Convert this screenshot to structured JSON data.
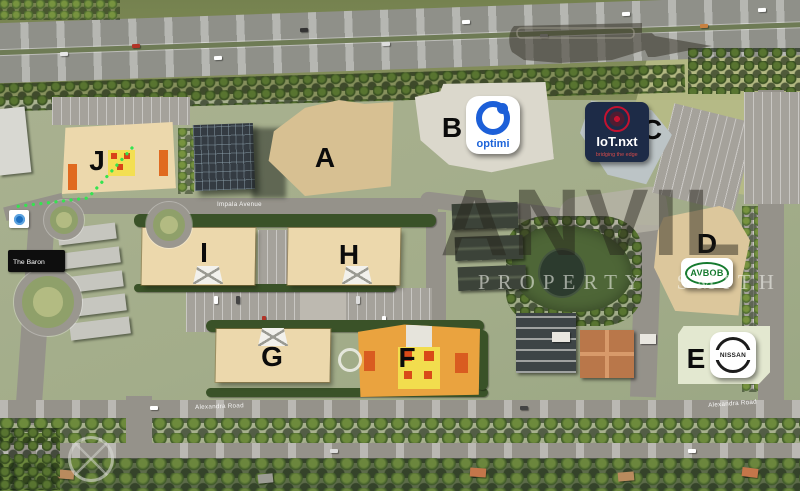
{
  "buildings": {
    "A": "A",
    "B": "B",
    "C": "C",
    "D": "D",
    "E": "E",
    "F": "F",
    "G": "G",
    "H": "H",
    "I": "I",
    "J": "J"
  },
  "tenants": {
    "optimi": {
      "name": "optimi"
    },
    "iotnxt": {
      "name": "IoT.nxt",
      "tagline": "bridging the edge"
    },
    "avbob": {
      "name": "AVBOB"
    },
    "nissan": {
      "name": "NISSAN"
    }
  },
  "roads": {
    "impala": "Impala Avenue",
    "alexandra_left": "Alexandra Road",
    "alexandra_right": "Alexandra Road"
  },
  "landmarks": {
    "baron": "The Baron"
  },
  "watermark": {
    "name": "ANVIL",
    "tagline": "PROPERTY SMITH"
  },
  "icons": {
    "anvil": "anvil-silhouette-icon",
    "optimi": "optimi-ring-icon",
    "iotnxt": "iotnxt-globe-icon",
    "nissan": "nissan-circle-icon",
    "transit": "blue-transit-dot-icon"
  },
  "colors": {
    "accent_orange": "#EAA33F",
    "building_tan": "#ECD8AC",
    "optimi_blue": "#1C5FD8",
    "iot_navy": "#1D2B47",
    "iot_red": "#C41230",
    "avbob_green": "#157A2E",
    "watermark_dark": "#26231B"
  }
}
